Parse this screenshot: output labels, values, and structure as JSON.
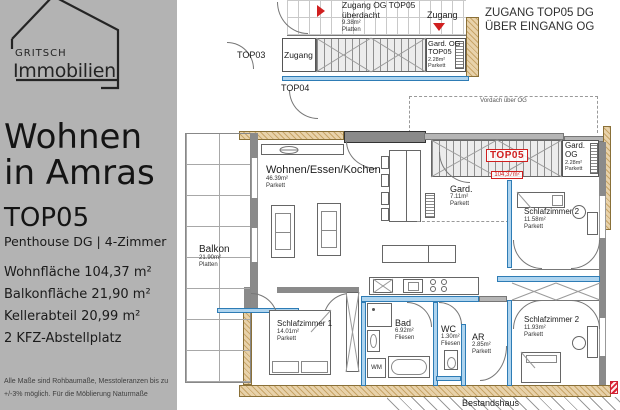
{
  "colors": {
    "sidebar_bg": "#b3b3b3",
    "accent_red": "#d01f1f",
    "wall_blue": "#2e7cb5",
    "tan_wall": "#d9bb86"
  },
  "sidebar": {
    "logo": {
      "line1": "GRITSCH",
      "line2": "Immobilien"
    },
    "title": {
      "line1": "Wohnen",
      "line2": "in Amras"
    },
    "unit": "TOP05",
    "subtitle": "Penthouse DG | 4-Zimmer",
    "facts": [
      "Wohnfläche 104,37 m²",
      "Balkonfläche 21,90 m²",
      "Kellerabteil 20,99 m²",
      "2 KFZ-Abstellplatz"
    ],
    "disclaimer": [
      "Alle Maße sind Rohbaumaße, Messtoleranzen bis zu",
      "+/-3% möglich. Für die Möblierung Naturmaße"
    ]
  },
  "plan": {
    "heading": {
      "line1": "ZUGANG TOP05 DG",
      "line2": "ÜBER EINGANG OG"
    },
    "vordach_label": "Vordach über OG",
    "bestandshaus_label": "Bestandshaus",
    "entry": {
      "zugang_og": {
        "line1": "Zugang OG TOP05",
        "line2": "überdacht",
        "area": "9.38m²",
        "floor": "Platten"
      },
      "zugang_top": "Zugang",
      "vestibule": "Zugang",
      "top03": "TOP03",
      "top04": "TOP04",
      "gard_og_top05": {
        "line1": "Gard. OG",
        "line2": "TOP05",
        "area": "2.28m²",
        "floor": "Parkett"
      }
    },
    "marker_top05": {
      "label": "TOP05",
      "area": "104,37m²"
    },
    "rooms": {
      "wohnen": {
        "name": "Wohnen/Essen/Kochen",
        "area": "46.39m²",
        "floor": "Parkett"
      },
      "balkon": {
        "name": "Balkon",
        "area": "21.90m²",
        "floor": "Platten"
      },
      "gard": {
        "name": "Gard.",
        "area": "7.11m²",
        "floor": "Parkett"
      },
      "gard_og": {
        "line1": "Gard.",
        "line2": "OG",
        "area": "2.28m²",
        "floor": "Parkett"
      },
      "schlafzimmer2_oben": {
        "name": "Schlafzimmer 2",
        "area": "11.58m²",
        "floor": "Parkett"
      },
      "schlafzimmer2_unten": {
        "name": "Schlafzimmer 2",
        "area": "11.93m²",
        "floor": "Parkett"
      },
      "schlafzimmer1": {
        "name": "Schlafzimmer 1",
        "area": "14.01m²",
        "floor": "Parkett"
      },
      "bad": {
        "name": "Bad",
        "area": "6.92m²",
        "floor": "Fliesen"
      },
      "wc": {
        "name": "WC",
        "area": "1.30m²",
        "floor": "Fliesen"
      },
      "ar": {
        "name": "AR",
        "area": "2.85m²",
        "floor": "Parkett"
      },
      "wm": "WM"
    }
  }
}
